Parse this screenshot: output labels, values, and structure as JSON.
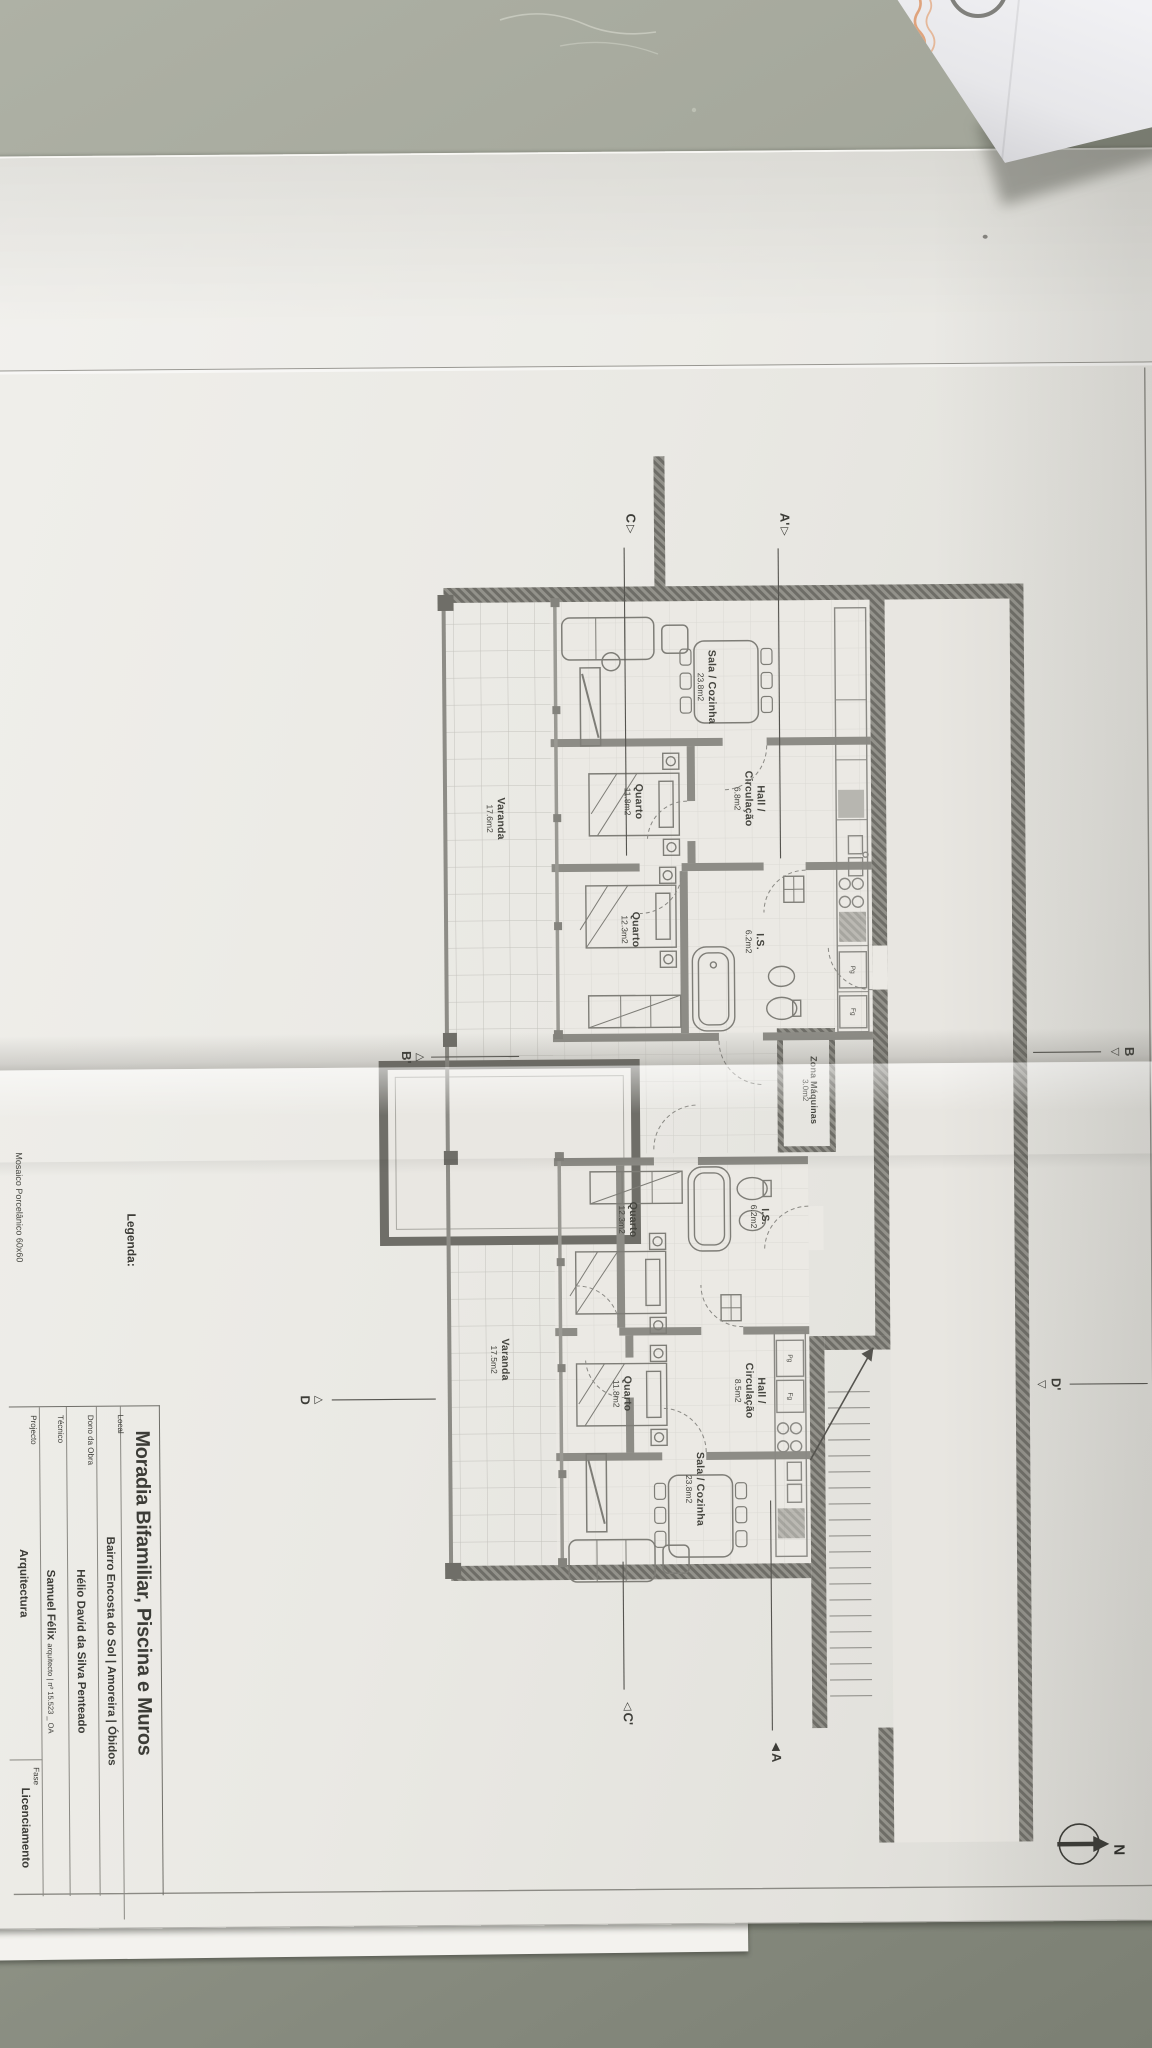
{
  "scene": {
    "description": "Photo of an architectural floor plan sheet on a desk",
    "colors": {
      "desk": "#9ea295",
      "paper": "#eae9e4",
      "plan_line": "#8a8984",
      "wall_fill": "#8d8c86",
      "text": "#45453f",
      "envelope_ink": "#dd9668"
    }
  },
  "envelope": {
    "ink_note": "illegible handwritten text"
  },
  "compass": {
    "label": "N"
  },
  "legend": {
    "heading": "Legenda:",
    "item": "Mosaico Porcelânico 60x60"
  },
  "titleblock": {
    "title": "Moradia Bifamiliar, Piscina e Muros",
    "local_label": "Local",
    "local": "Bairro Encosta do Sol | Amoreira | Óbidos",
    "dono_label": "Dono da Obra",
    "dono": "Hélio David da Silva Penteado",
    "tecnico_label": "Técnico",
    "tecnico": "Samuel Félix",
    "tecnico_suffix": "arquitecto | nº 15.523 _ OA",
    "projecto_label": "Projecto",
    "projecto": "Arquitectura",
    "fase_label": "Fase",
    "fase": "Licenciamento"
  },
  "plan": {
    "units": [
      {
        "name": "unit-1",
        "rooms": {
          "sala": {
            "name": "Sala / Cozinha",
            "area": "23.8m2"
          },
          "hall": {
            "name": "Hall /",
            "name2": "Circulação",
            "area": "6.8m2"
          },
          "quarto1": {
            "name": "Quarto",
            "area": "11.8m2"
          },
          "quarto2": {
            "name": "Quarto",
            "area": "12.3m2"
          },
          "is": {
            "name": "I.S.",
            "area": "6.2m2"
          },
          "varanda": {
            "name": "Varanda",
            "area": "17.6m2"
          }
        }
      },
      {
        "name": "unit-2",
        "rooms": {
          "sala": {
            "name": "Sala / Cozinha",
            "area": "23.8m2"
          },
          "hall": {
            "name": "Hall /",
            "name2": "Circulação",
            "area": "8.5m2"
          },
          "quarto1": {
            "name": "Quarto",
            "area": "11.8m2"
          },
          "quarto2": {
            "name": "Quarto",
            "area": "12.3m2"
          },
          "is": {
            "name": "I.S.",
            "area": "6.2m2"
          },
          "varanda": {
            "name": "Varanda",
            "area": "17.5m2"
          }
        }
      }
    ],
    "zona": {
      "name": "Zona Máquinas",
      "area": "3.0m2"
    },
    "kitchen": {
      "fridge": "Fg",
      "pantry": "Pg"
    },
    "markers": {
      "a1": "A'",
      "a2": "A",
      "b1": "B",
      "b2": "B'",
      "c1": "C",
      "c2": "C'",
      "d1": "D",
      "d2": "D'"
    }
  }
}
